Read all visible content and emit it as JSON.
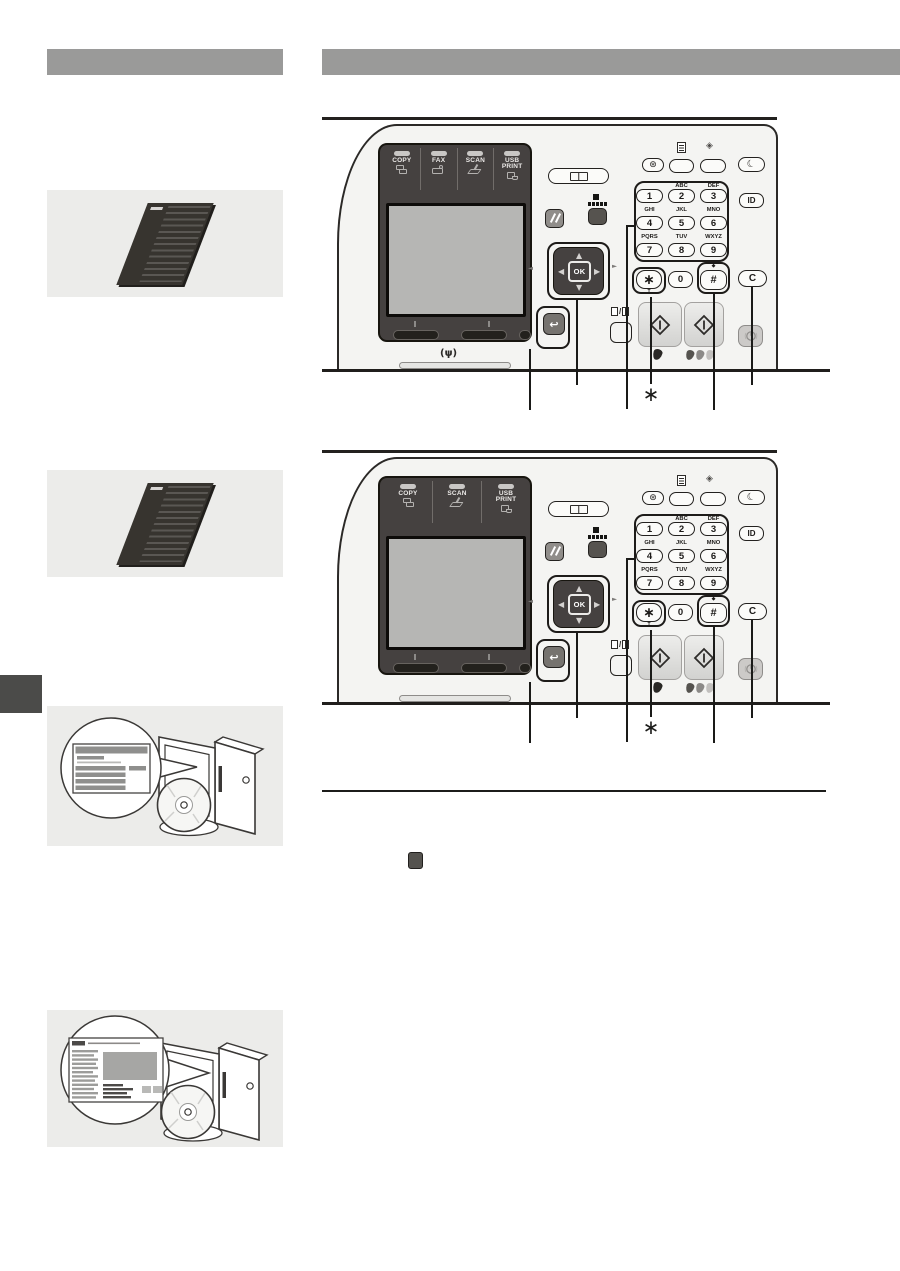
{
  "headers": {
    "left_section_bar_text": "",
    "main_section_bar_text": ""
  },
  "cp": {
    "mode_keys_full": [
      "COPY",
      "FAX",
      "SCAN",
      "USB PRINT"
    ],
    "mode_keys_basic": [
      "COPY",
      "SCAN",
      "USB PRINT"
    ],
    "digits": [
      "1",
      "2",
      "3",
      "4",
      "5",
      "6",
      "7",
      "8",
      "9"
    ],
    "letters": [
      "",
      "ABC",
      "DEF",
      "GHI",
      "JKL",
      "MNO",
      "PQRS",
      "TUV",
      "WXYZ"
    ],
    "zero": "0",
    "star_key": "∗",
    "hash_key": "#",
    "tone_mark": "T",
    "hash_mark": "◆",
    "ok_label": "OK",
    "id_label": "ID",
    "clear_label": "C",
    "sleep_icon": "☾",
    "quiet_icon": "⊛",
    "counter_icon": "◈",
    "back_icon": "↩",
    "nav_up": "▲",
    "nav_down": "▼",
    "nav_left": "◀",
    "nav_right": "▶",
    "vol_left": "◄",
    "vol_right": "►",
    "wifi_mark": "(ψ)",
    "footnote_star": "∗"
  },
  "colors": {
    "header_bar": "#9a9a99",
    "illustration_bg": "#ececea",
    "chapter_tab": "#4b4b49",
    "panel_face": "#f4f4f2",
    "panel_dark_block": "#454140",
    "lcd_screen": "#b6b6b4",
    "key_face": "#fbfbf9",
    "outline": "#23211f",
    "mode_key_led": "#c9c7c5",
    "start_key": "#d2d2d0"
  }
}
